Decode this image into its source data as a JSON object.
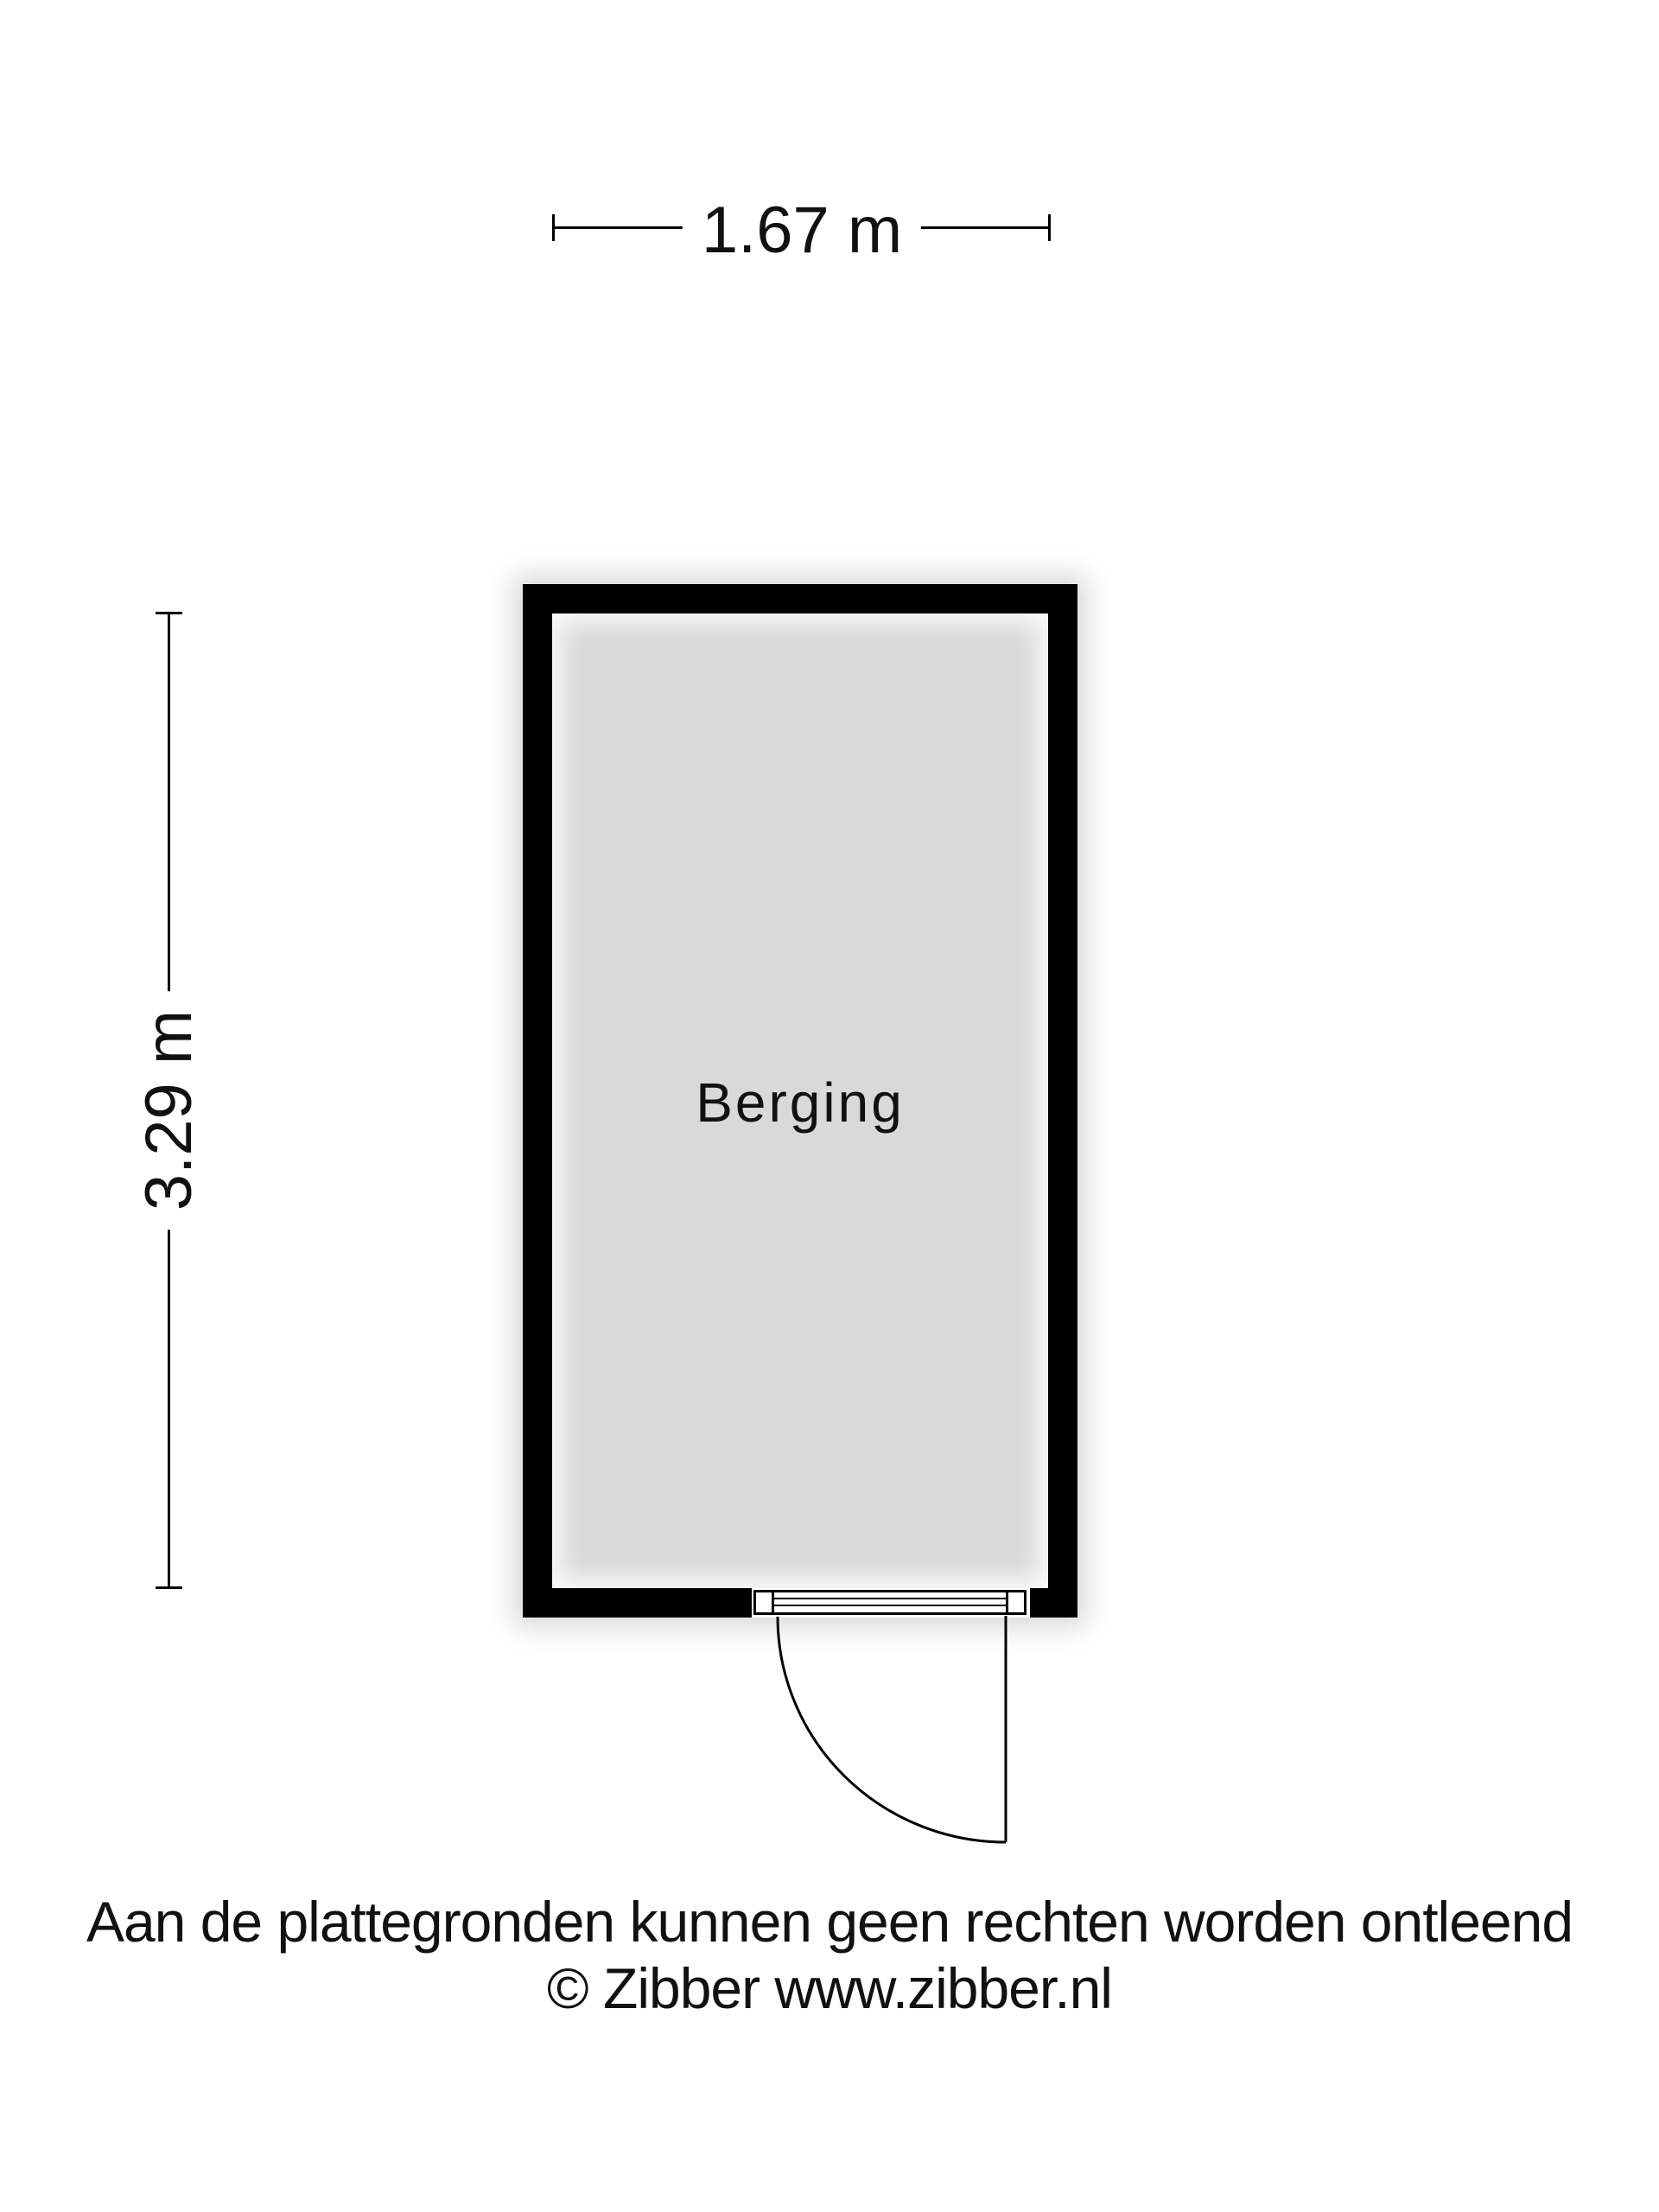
{
  "floorplan": {
    "room": {
      "label": "Berging"
    },
    "dimensions": {
      "width_label": "1.67 m",
      "height_label": "3.29 m"
    },
    "footer": {
      "disclaimer": "Aan de plattegronden kunnen geen rechten worden ontleend",
      "copyright": "© Zibber www.zibber.nl"
    },
    "colors": {
      "wall": "#000000",
      "floor": "#d9d9d9",
      "background": "#ffffff",
      "text": "#111111"
    }
  }
}
